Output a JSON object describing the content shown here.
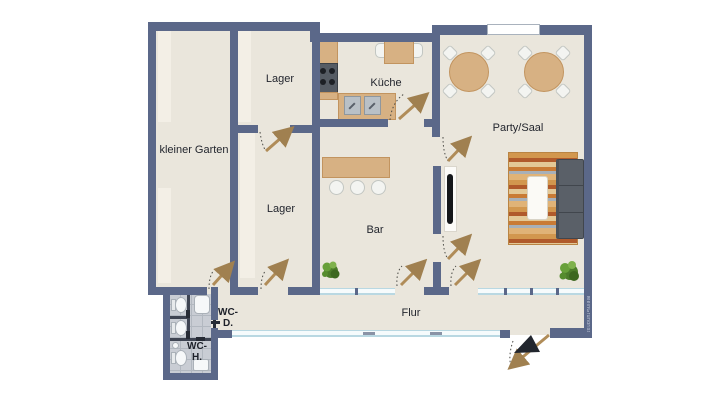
{
  "title": "floor plan",
  "rooms": {
    "garten": {
      "label": "kleiner Garten"
    },
    "lager_top": {
      "label": "Lager"
    },
    "lager_bottom": {
      "label": "Lager"
    },
    "kueche": {
      "label": "Küche"
    },
    "bar": {
      "label": "Bar"
    },
    "party": {
      "label": "Party/Saal"
    },
    "flur": {
      "label": "Flur"
    },
    "wc_d": {
      "line1": "WC-",
      "line2": "D."
    },
    "wc_h": {
      "line1": "WC-",
      "line2": "H."
    }
  },
  "watermark": "MeinGrundriss",
  "colors": {
    "wall": "#5b6889",
    "floor": "#eae6dc",
    "wood": "#d7b183",
    "wood_border": "#c2945f",
    "tile": "#c9cdd4",
    "sofa": "#5a6068",
    "leaf": "#b08c58",
    "plant": "#4c7c2a"
  }
}
